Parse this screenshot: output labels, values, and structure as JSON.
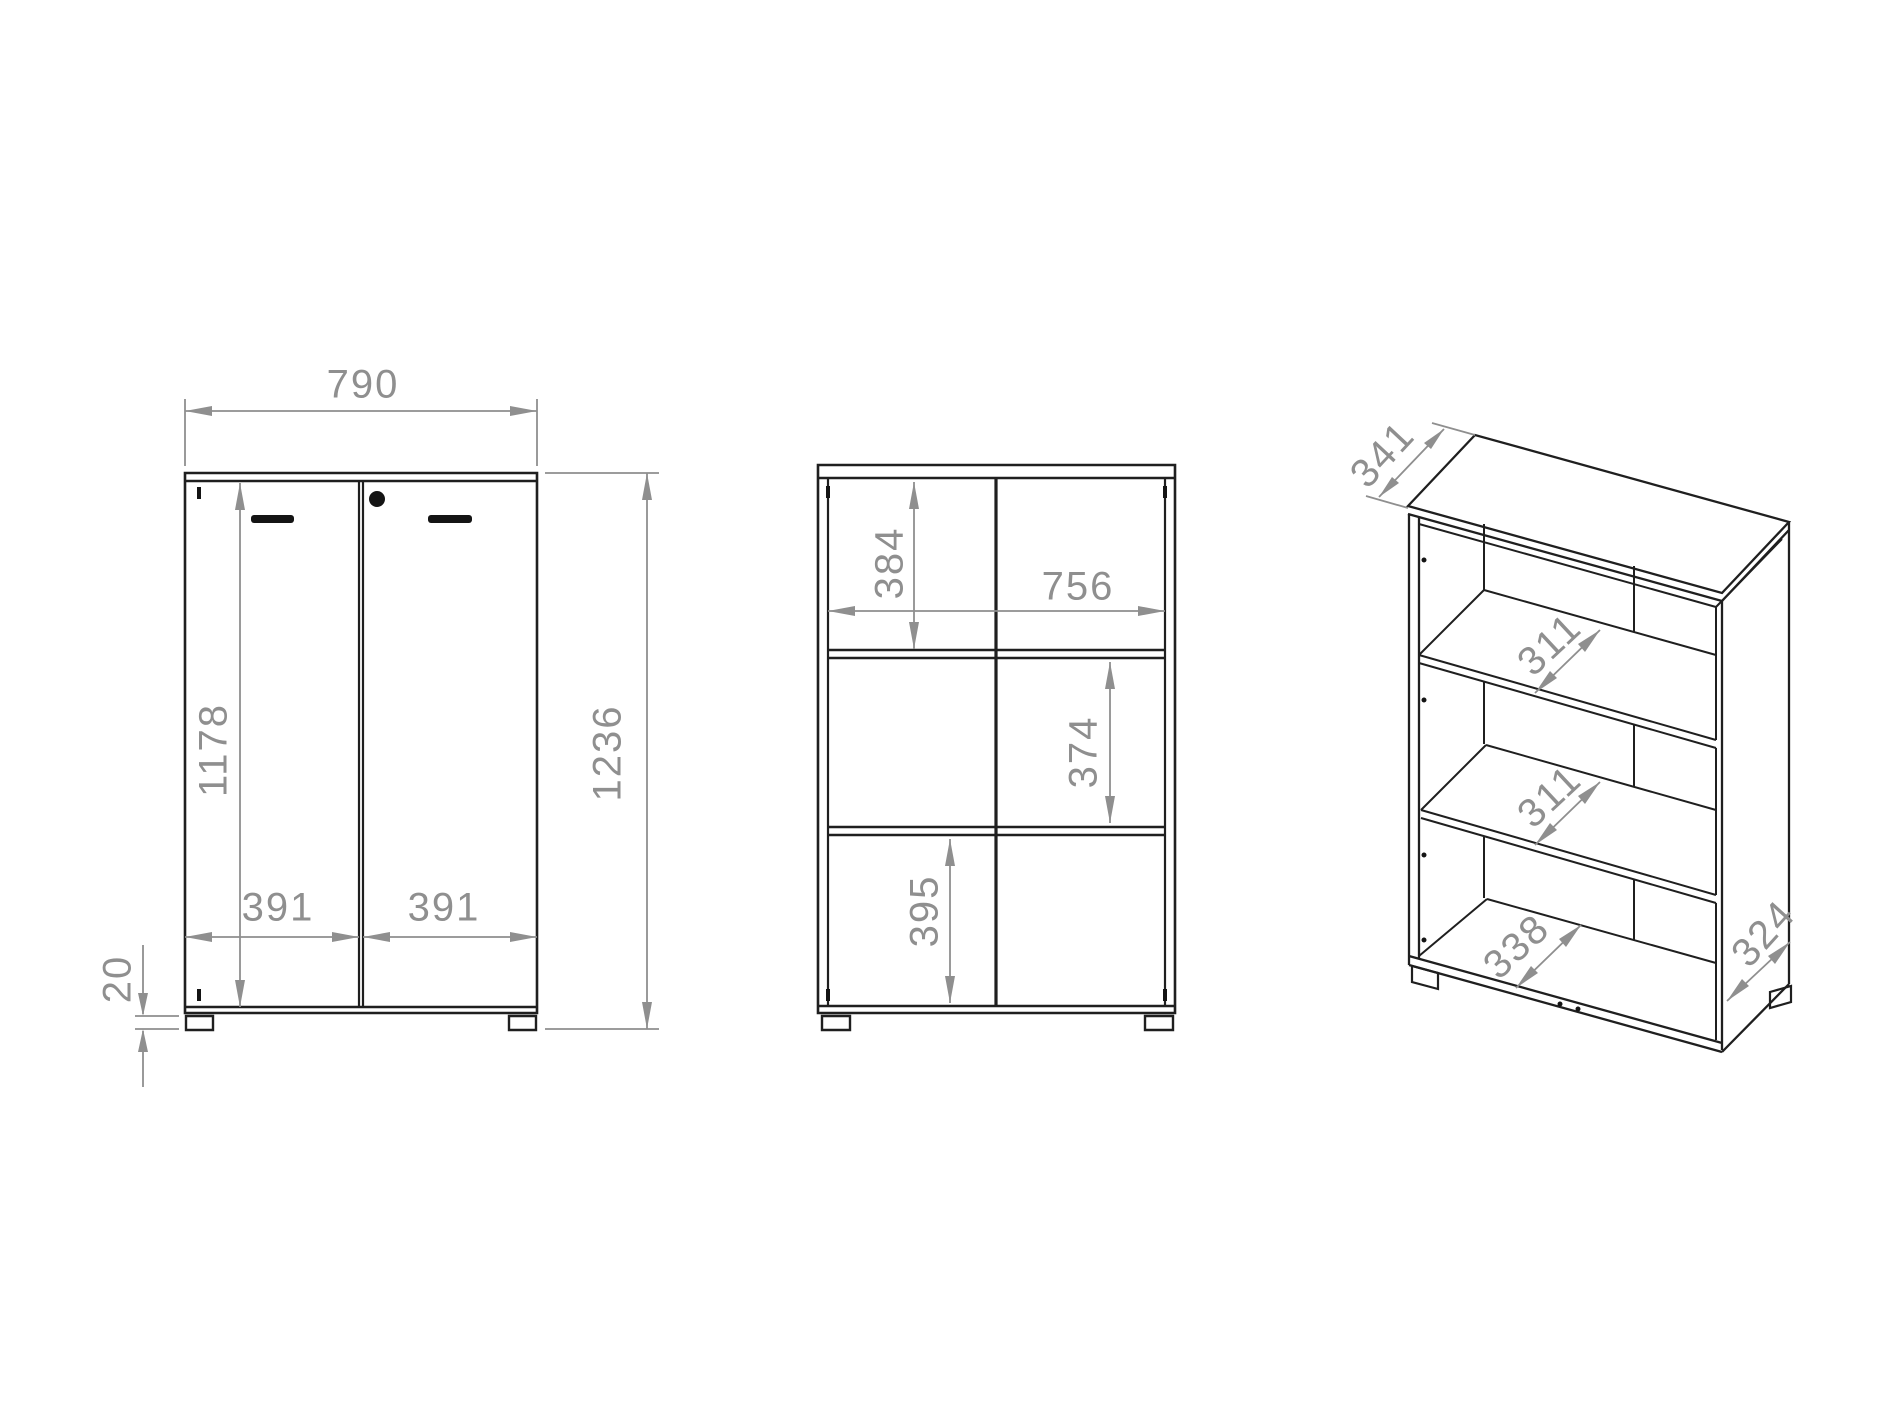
{
  "views": {
    "front": {
      "label": "front view with doors",
      "dims": {
        "width": "790",
        "total_height": "1236",
        "door_height": "1178",
        "left_door_width": "391",
        "right_door_width": "391",
        "foot_height": "20"
      }
    },
    "section": {
      "label": "front section view",
      "dims": {
        "top_compartment_height": "384",
        "interior_width": "756",
        "middle_compartment_height": "374",
        "bottom_compartment_height": "395"
      }
    },
    "perspective": {
      "label": "isometric view",
      "dims": {
        "top_depth": "341",
        "upper_shelf_depth": "311",
        "lower_shelf_depth": "311",
        "bottom_panel_width": "338",
        "side_panel_depth": "324"
      }
    }
  },
  "colors": {
    "outline": "#1f1f1f",
    "dimension": "#8f8f8f",
    "background": "#ffffff"
  }
}
